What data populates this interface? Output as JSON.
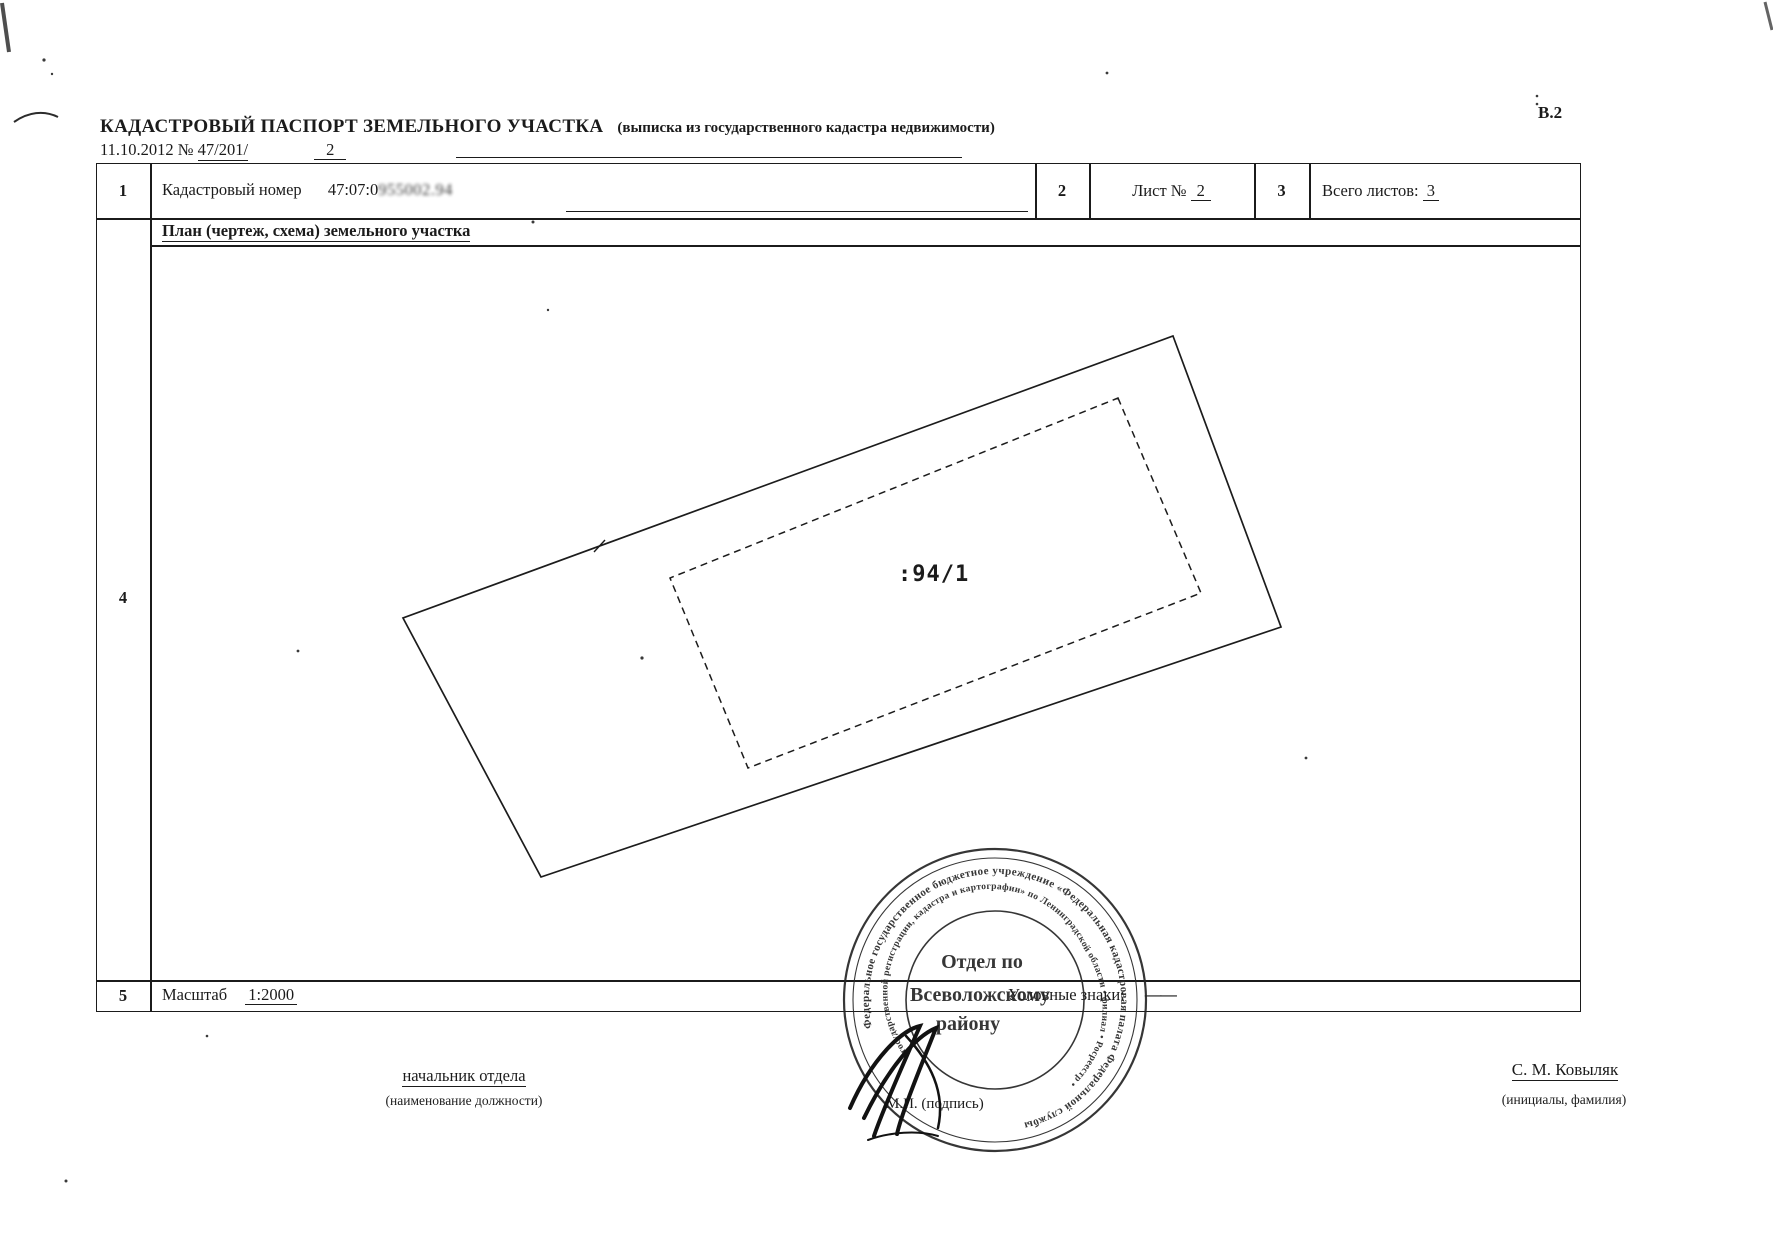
{
  "doc": {
    "form_code": "В.2",
    "title": "КАДАСТРОВЫЙ ПАСПОРТ ЗЕМЕЛЬНОГО УЧАСТКА",
    "subtitle": "(выписка из государственного кадастра недвижимости)",
    "date": "11.10.2012",
    "no_sign": "№",
    "doc_number": "47/201/",
    "doc_number_suffix": "2"
  },
  "table": {
    "r1_num": "1",
    "r1_label": "Кадастровый номер",
    "cad_prefix": "47:07:0",
    "cad_smudge": "955002.94",
    "r1_col2": "2",
    "sheet_label": "Лист №",
    "sheet_value": "2",
    "r1_col3": "3",
    "total_label": "Всего листов:",
    "total_value": "3",
    "plan_header": "План (чертеж, схема) земельного участка",
    "r4_num": "4",
    "r5_num": "5",
    "scale_label": "Масштаб",
    "scale_value": "1:2000",
    "legend_label": "Условные знаки:",
    "legend_dash": "——"
  },
  "plan": {
    "parcel_label": ":94/1"
  },
  "stamp": {
    "ring_outer": "Федеральное государственное бюджетное учреждение «Федеральная кадастровая палата Федеральной службы",
    "ring_inner": "государственной регистрации, кадастра и картографии» по Ленинградской области • филиал • Росреестр •",
    "center1": "Отдел по",
    "center2": "Всеволожскому",
    "center3": "району"
  },
  "footer": {
    "position": "начальник отдела",
    "position_caption": "(наименование должности)",
    "stamp_sign": "М.П. (подпись)",
    "name": "С. М. Ковыляк",
    "name_caption": "(инициалы, фамилия)"
  }
}
